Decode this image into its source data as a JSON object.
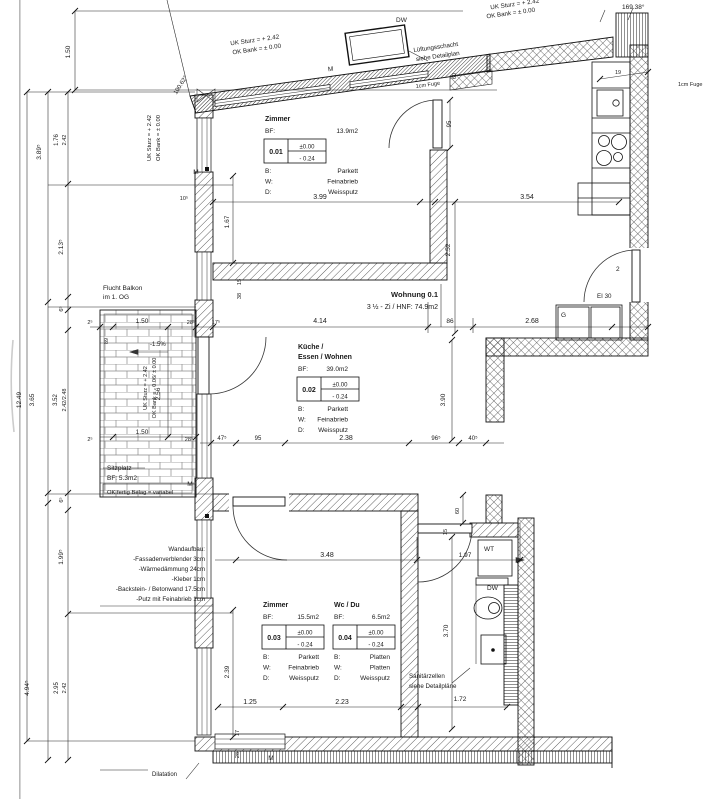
{
  "drawing": {
    "unit": {
      "title": "Wohnung 0.1",
      "subtitle": "3 ½ - Zi / HNF: 74.9m2"
    },
    "rooms": [
      {
        "number": "0.01",
        "title": [
          "Zimmer"
        ],
        "bf_label": "BF:",
        "area": "13.9m2",
        "level_top": "±0.00",
        "level_bottom": "- 0.24",
        "finishes": [
          [
            "B:",
            "Parkett"
          ],
          [
            "W:",
            "Feinabrieb"
          ],
          [
            "D:",
            "Weissputz"
          ]
        ],
        "pos": {
          "x": 265,
          "y": 121,
          "right": 358
        }
      },
      {
        "number": "0.02",
        "title": [
          "Küche /",
          "Essen / Wohnen"
        ],
        "bf_label": "BF:",
        "area": "39.0m2",
        "level_top": "±0.00",
        "level_bottom": "- 0.24",
        "finishes": [
          [
            "B:",
            "Parkett"
          ],
          [
            "W:",
            "Feinabrieb"
          ],
          [
            "D:",
            "Weissputz"
          ]
        ],
        "pos": {
          "x": 298,
          "y": 349,
          "right": 348
        }
      },
      {
        "number": "0.03",
        "title": [
          "Zimmer"
        ],
        "bf_label": "BF:",
        "area": "15.5m2",
        "level_top": "±0.00",
        "level_bottom": "- 0.24",
        "finishes": [
          [
            "B:",
            "Parkett"
          ],
          [
            "W:",
            "Feinabrieb"
          ],
          [
            "D:",
            "Weissputz"
          ]
        ],
        "pos": {
          "x": 263,
          "y": 607,
          "right": 319
        }
      },
      {
        "number": "0.04",
        "title": [
          "Wc / Du"
        ],
        "bf_label": "BF:",
        "area": "6.5m2",
        "level_top": "±0.00",
        "level_bottom": "- 0.24",
        "finishes": [
          [
            "B:",
            "Platten"
          ],
          [
            "W:",
            "Platten"
          ],
          [
            "D:",
            "Weissputz"
          ]
        ],
        "pos": {
          "x": 334,
          "y": 607,
          "right": 390
        }
      }
    ],
    "labels": [
      {
        "t": "Wohnung 0.1",
        "x": 438,
        "y": 297,
        "a": "end",
        "b": true,
        "s": 7.5,
        "n": "unit-title"
      },
      {
        "t": "3 ½ - Zi / HNF: 74.9m2",
        "x": 438,
        "y": 309,
        "a": "end",
        "s": 7,
        "n": "unit-subtitle"
      },
      {
        "t": "Flucht Balkon",
        "x": 103,
        "y": 290,
        "a": "start",
        "s": 6.5,
        "n": "escape-balcony-note"
      },
      {
        "t": "im 1. OG",
        "x": 103,
        "y": 299,
        "a": "start",
        "s": 6.5
      },
      {
        "t": "Sitzplatz",
        "x": 107,
        "y": 470,
        "a": "start",
        "s": 6.5,
        "n": "sitzplatz-label"
      },
      {
        "t": "BF: 5.3m2",
        "x": 107,
        "y": 480,
        "a": "start",
        "s": 6.5,
        "n": "sitzplatz-area"
      },
      {
        "t": "OK fertig Belag = variabel",
        "x": 107,
        "y": 494,
        "a": "start",
        "s": 5.8,
        "n": "sitzplatz-level-note"
      },
      {
        "t": "Wandaufbau:",
        "x": 205,
        "y": 551,
        "a": "end",
        "s": 6.2,
        "n": "wall-buildup-title"
      },
      {
        "t": "-Fassadenverblender 3cm",
        "x": 205,
        "y": 561,
        "a": "end",
        "s": 6.2
      },
      {
        "t": "-Wärmedämmung 24cm",
        "x": 205,
        "y": 571,
        "a": "end",
        "s": 6.2
      },
      {
        "t": "-Kleber 1cm",
        "x": 205,
        "y": 581,
        "a": "end",
        "s": 6.2
      },
      {
        "t": "-Backstein- / Betonwand 17.5cm",
        "x": 205,
        "y": 591,
        "a": "end",
        "s": 6.2
      },
      {
        "t": "-Putz mit Feinabrieb 1cm",
        "x": 205,
        "y": 601,
        "a": "end",
        "s": 6.2
      },
      {
        "t": "Sanitärzellen",
        "x": 409,
        "y": 678,
        "a": "start",
        "s": 6.2,
        "n": "sanitary-note"
      },
      {
        "t": "siehe Detailpläne",
        "x": 409,
        "y": 688,
        "a": "start",
        "s": 6.2
      },
      {
        "t": "EI 30",
        "x": 597,
        "y": 298,
        "a": "start",
        "s": 6.2,
        "n": "fire-rating-label"
      },
      {
        "t": "G",
        "x": 561,
        "y": 317,
        "a": "start",
        "s": 6.5,
        "n": "wardrobe-label"
      },
      {
        "t": "2",
        "x": 616,
        "y": 271,
        "a": "start",
        "s": 6.5,
        "n": "door-number"
      },
      {
        "t": "WT",
        "x": 484,
        "y": 551,
        "a": "start",
        "s": 6.5,
        "n": "washbasin-label"
      },
      {
        "t": "DW",
        "x": 487,
        "y": 590,
        "a": "start",
        "s": 6.5,
        "n": "shower-label"
      },
      {
        "t": "DW",
        "x": 396,
        "y": 22,
        "a": "start",
        "s": 6.5,
        "n": "duct-label"
      },
      {
        "t": "M",
        "x": 196,
        "y": 174,
        "a": "middle",
        "s": 6.5,
        "n": "window-marker"
      },
      {
        "t": "M",
        "x": 331,
        "y": 71,
        "a": "middle",
        "s": 6.5,
        "r": -8,
        "n": "window-marker"
      },
      {
        "t": "M",
        "x": 190,
        "y": 486,
        "a": "middle",
        "s": 6.5,
        "n": "window-marker"
      },
      {
        "t": "M",
        "x": 271,
        "y": 760,
        "a": "middle",
        "s": 6.5,
        "n": "window-marker"
      },
      {
        "t": "Dilatation",
        "x": 152,
        "y": 776,
        "a": "start",
        "s": 6,
        "n": "dilatation-label"
      },
      {
        "t": "1cm Fuge",
        "x": 416,
        "y": 88,
        "a": "start",
        "s": 5.5,
        "r": -8,
        "n": "joint-note"
      },
      {
        "t": "1cm Fuge",
        "x": 678,
        "y": 86,
        "a": "start",
        "s": 5.5,
        "n": "joint-note"
      },
      {
        "t": "169.38°",
        "x": 622,
        "y": 9,
        "a": "start",
        "s": 6.5,
        "n": "angle-dim"
      },
      {
        "t": "100.62°",
        "x": 182,
        "y": 86,
        "a": "middle",
        "s": 6,
        "r": -58,
        "n": "angle-dim"
      },
      {
        "t": "UK Sturz =  + 2.42",
        "x": 151,
        "y": 138,
        "a": "middle",
        "s": 5.8,
        "r": -90,
        "n": "lintel-level-note"
      },
      {
        "t": "OK Bank =  ± 0.00",
        "x": 160,
        "y": 138,
        "a": "middle",
        "s": 5.8,
        "r": -90
      },
      {
        "t": "UK Sturz =  + 2.42",
        "x": 255,
        "y": 42,
        "a": "middle",
        "s": 6.2,
        "r": -8,
        "n": "lintel-level-note"
      },
      {
        "t": "OK Bank =  ± 0.00",
        "x": 257,
        "y": 51,
        "a": "middle",
        "s": 6.2,
        "r": -8
      },
      {
        "t": "UK Sturz =  + 2.42",
        "x": 515,
        "y": 6,
        "a": "middle",
        "s": 6.2,
        "r": -8,
        "n": "lintel-level-note"
      },
      {
        "t": "OK Bank =  ± 0.00",
        "x": 511,
        "y": 15,
        "a": "middle",
        "s": 6.2,
        "r": -8
      },
      {
        "t": "Lüftungsschacht",
        "x": 436,
        "y": 49,
        "a": "middle",
        "s": 6.2,
        "r": -8,
        "n": "vent-shaft-note"
      },
      {
        "t": "siehe Detailplan",
        "x": 438,
        "y": 58,
        "a": "middle",
        "s": 6.2,
        "r": -8
      },
      {
        "t": "-1.5%",
        "x": 150,
        "y": 346,
        "a": "start",
        "s": 6,
        "n": "slope-label"
      },
      {
        "t": "UK Sturz = + 2.42",
        "x": 147,
        "y": 388,
        "a": "middle",
        "s": 5.5,
        "r": -90,
        "n": "balcony-level-note"
      },
      {
        "t": "OK Bank = - 0.06/ ± 0.00",
        "x": 156,
        "y": 388,
        "a": "middle",
        "s": 5.5,
        "r": -90
      },
      {
        "t": "12.49",
        "x": 21,
        "y": 400,
        "r": -90,
        "s": 6.5,
        "n": "dim-total-height"
      },
      {
        "t": "3.65",
        "x": 34,
        "y": 400,
        "r": -90,
        "s": 6.5
      },
      {
        "t": "3.52",
        "x": 57,
        "y": 400,
        "r": -90,
        "s": 6
      },
      {
        "t": "2.42/2.48",
        "x": 66,
        "y": 400,
        "r": -90,
        "s": 5.5
      },
      {
        "t": "3.89⁵",
        "x": 41,
        "y": 152,
        "r": -90,
        "s": 6.5
      },
      {
        "t": "1.76",
        "x": 58,
        "y": 140,
        "r": -90,
        "s": 6
      },
      {
        "t": "2.42",
        "x": 66,
        "y": 140,
        "r": -90,
        "s": 5.5
      },
      {
        "t": "2.13⁵",
        "x": 63,
        "y": 247,
        "r": -90,
        "s": 6.5
      },
      {
        "t": "6⁵",
        "x": 63,
        "y": 309,
        "r": -90,
        "s": 5.5
      },
      {
        "t": "6⁵",
        "x": 63,
        "y": 500,
        "r": -90,
        "s": 5.5
      },
      {
        "t": "1.99⁵",
        "x": 63,
        "y": 557,
        "r": -90,
        "s": 6.5
      },
      {
        "t": "2.95",
        "x": 58,
        "y": 688,
        "r": -90,
        "s": 6
      },
      {
        "t": "2.42",
        "x": 66,
        "y": 688,
        "r": -90,
        "s": 5.5
      },
      {
        "t": "4.94⁵",
        "x": 29,
        "y": 688,
        "r": -90,
        "s": 6.5
      },
      {
        "t": "1.50",
        "x": 70,
        "y": 52,
        "r": -90,
        "s": 6.5
      },
      {
        "t": "3.99",
        "x": 320,
        "y": 199,
        "s": 7
      },
      {
        "t": "3.54",
        "x": 527,
        "y": 199,
        "s": 7
      },
      {
        "t": "95",
        "x": 451,
        "y": 124,
        "r": -90,
        "s": 6
      },
      {
        "t": "60",
        "x": 456,
        "y": 76,
        "r": -90,
        "s": 5.5
      },
      {
        "t": "19",
        "x": 618,
        "y": 74,
        "s": 5.5
      },
      {
        "t": "10⁵",
        "x": 184,
        "y": 200,
        "s": 5.5
      },
      {
        "t": "1.67",
        "x": 229,
        "y": 222,
        "r": -90,
        "s": 6.5
      },
      {
        "t": "15",
        "x": 241,
        "y": 282,
        "r": -90,
        "s": 5.5
      },
      {
        "t": "38",
        "x": 241,
        "y": 296,
        "r": -90,
        "s": 5.5
      },
      {
        "t": "28⁵",
        "x": 191,
        "y": 324,
        "s": 5.5
      },
      {
        "t": "17⁵",
        "x": 216,
        "y": 324,
        "s": 5.5
      },
      {
        "t": "2⁵",
        "x": 90,
        "y": 324,
        "s": 5.5
      },
      {
        "t": "2⁵",
        "x": 90,
        "y": 441,
        "s": 5.5
      },
      {
        "t": "28⁵",
        "x": 189,
        "y": 441,
        "s": 5.5
      },
      {
        "t": "1.50",
        "x": 142,
        "y": 323,
        "s": 6.5
      },
      {
        "t": "4.14",
        "x": 320,
        "y": 323,
        "s": 7
      },
      {
        "t": "86",
        "x": 450,
        "y": 323,
        "s": 6.5
      },
      {
        "t": "2.68",
        "x": 532,
        "y": 323,
        "s": 7
      },
      {
        "t": "89",
        "x": 108,
        "y": 341,
        "r": -90,
        "s": 5.5
      },
      {
        "t": "2.56",
        "x": 160,
        "y": 394,
        "r": -90,
        "s": 6.5
      },
      {
        "t": "1.50",
        "x": 142,
        "y": 434,
        "s": 6.5
      },
      {
        "t": "2.52",
        "x": 450,
        "y": 250,
        "r": -90,
        "s": 6.5
      },
      {
        "t": "47⁵",
        "x": 222,
        "y": 440,
        "s": 6
      },
      {
        "t": "95",
        "x": 258,
        "y": 440,
        "s": 6
      },
      {
        "t": "2.38",
        "x": 346,
        "y": 440,
        "s": 7
      },
      {
        "t": "96⁵",
        "x": 436,
        "y": 440,
        "s": 6
      },
      {
        "t": "40⁵",
        "x": 473,
        "y": 440,
        "s": 6
      },
      {
        "t": "3.90",
        "x": 445,
        "y": 400,
        "r": -90,
        "s": 6.5
      },
      {
        "t": "60",
        "x": 459,
        "y": 511,
        "r": -90,
        "s": 5.5
      },
      {
        "t": "3.48",
        "x": 327,
        "y": 557,
        "s": 7
      },
      {
        "t": "1.97",
        "x": 465,
        "y": 557,
        "s": 6.5
      },
      {
        "t": "15",
        "x": 447,
        "y": 532,
        "r": -90,
        "s": 5.5
      },
      {
        "t": "2.39",
        "x": 229,
        "y": 672,
        "r": -90,
        "s": 6.5
      },
      {
        "t": "3.70",
        "x": 448,
        "y": 631,
        "r": -90,
        "s": 6.5
      },
      {
        "t": "1.25",
        "x": 250,
        "y": 704,
        "s": 7
      },
      {
        "t": "2.23",
        "x": 342,
        "y": 704,
        "s": 7
      },
      {
        "t": "1.72",
        "x": 460,
        "y": 701,
        "s": 6.5
      },
      {
        "t": "17",
        "x": 239,
        "y": 733,
        "r": -90,
        "s": 5.5
      },
      {
        "t": "28",
        "x": 239,
        "y": 755,
        "r": -90,
        "s": 5.5
      }
    ]
  }
}
